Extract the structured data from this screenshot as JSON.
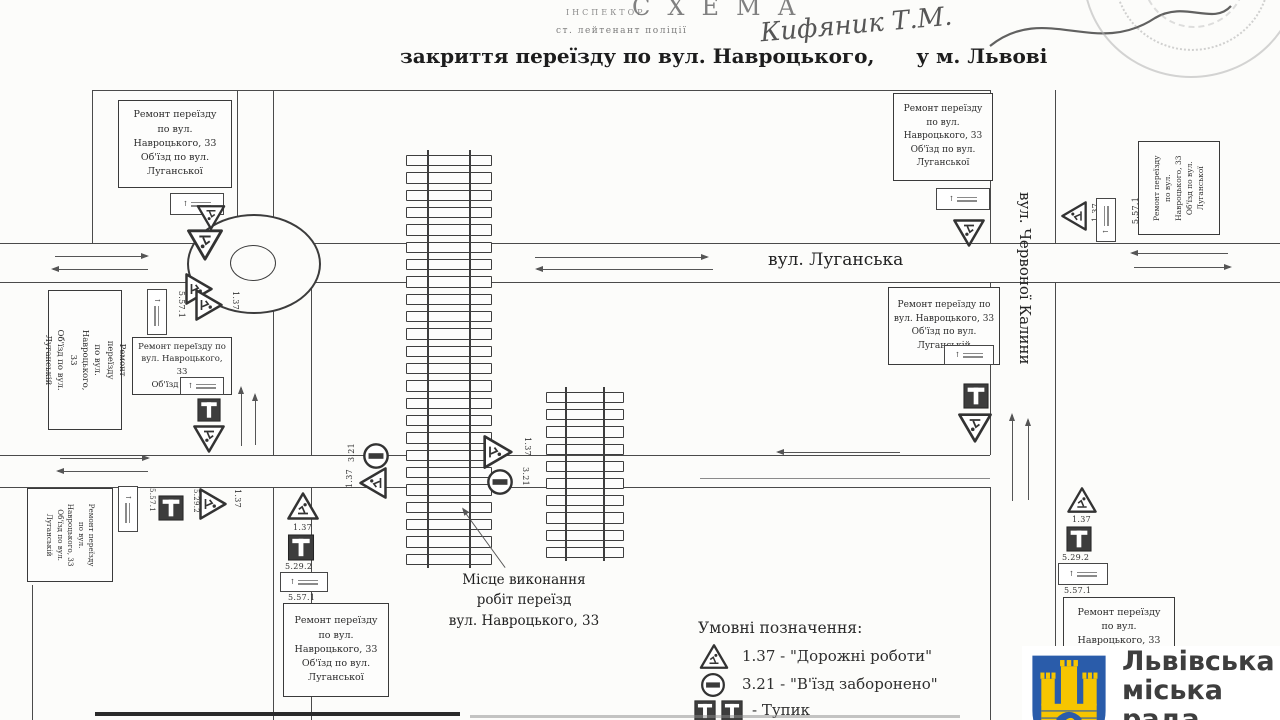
{
  "header": {
    "inspector": "ІНСПЕКТОР",
    "scheme": "СХЕМА",
    "rank": "ст. лейтенант поліції",
    "signature": "Кифяник Т.М.",
    "title": "закриття переїзду по вул. Навроцького,      у м. Львові"
  },
  "streets": {
    "luhanska": "вул. Луганська",
    "kalyny": "вул. Червоної Калини"
  },
  "boxes": {
    "detour5a": "Ремонт переїзду\nпо вул.\nНавроцького, 33\nОб'їзд по вул.\nЛуганської",
    "detour5b": "Ремонт переїзду\nпо вул.\nНавроцького, 33\nОб'їзд по вул.\nЛуганській",
    "detour4": "Ремонт переїзду по\nвул. Навроцького, 33\nОб'їзд по вул.\nЛуганській",
    "detour3": "Ремонт переїзду по\nвул. Навроцького, 33\nОб'їзд по вул.",
    "detour_br": "Ремонт переїзду\nпо вул.\nНавроцького, 33"
  },
  "callout": "Місце виконання\nробіт переїзд\nвул. Навроцького, 33",
  "signs": {
    "road_works": "1.37",
    "no_entry": "3.21",
    "dead_end": "5.29.2",
    "info": "5.57.1",
    "up": "↑"
  },
  "legend": {
    "title": "Умовні позначення:",
    "items": [
      {
        "label": "1.37 - \"Дорожні роботи\""
      },
      {
        "label": "3.21 - \"В'їзд заборонено\""
      },
      {
        "label": "- Тупик"
      }
    ]
  },
  "logo": {
    "l1": "Львівська",
    "l2": "міська",
    "l3": "рада",
    "blue": "#2a5caa",
    "yellow": "#f6c500"
  }
}
